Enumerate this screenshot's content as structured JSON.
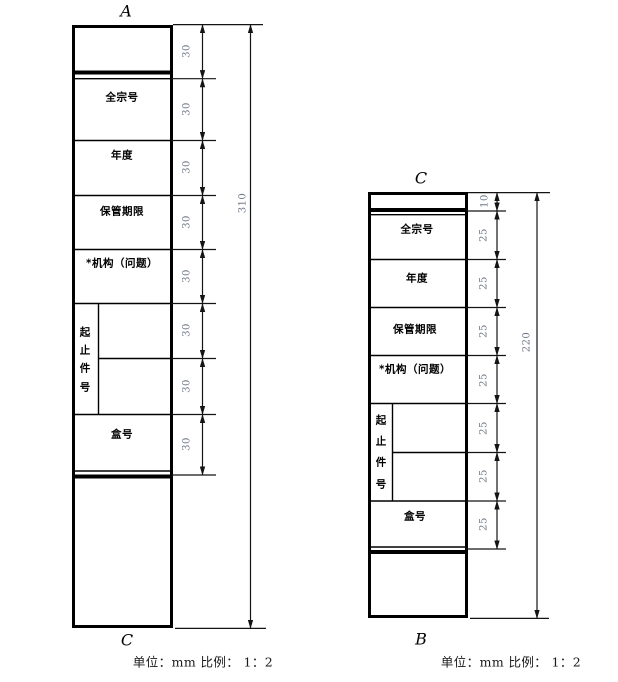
{
  "figure": {
    "left_drawing": {
      "top_label": "A",
      "bottom_label": "C",
      "rows": {
        "fonds_no": "全宗号",
        "year": "年度",
        "retention": "保管期限",
        "org_issue": "*机构（问题）",
        "item_range": [
          "起",
          "止",
          "件",
          "号"
        ],
        "box_no": "盒号"
      },
      "segment_dims": [
        "30",
        "30",
        "30",
        "30",
        "30",
        "30",
        "30",
        "30"
      ],
      "total_dim": "310"
    },
    "right_drawing": {
      "top_label": "C",
      "bottom_label": "B",
      "rows": {
        "fonds_no": "全宗号",
        "year": "年度",
        "retention": "保管期限",
        "org_issue": "*机构（问题）",
        "item_range": [
          "起",
          "止",
          "件",
          "号"
        ],
        "box_no": "盒号"
      },
      "segment_dims": [
        "10",
        "25",
        "25",
        "25",
        "25",
        "25",
        "25",
        "25"
      ],
      "total_dim": "220"
    },
    "caption_left": "单位：mm 比例： 1：2",
    "caption_right": "单位：mm 比例： 1：2",
    "colors": {
      "line": "#000000",
      "dim_text": "#707a8a",
      "text": "#000000"
    }
  }
}
